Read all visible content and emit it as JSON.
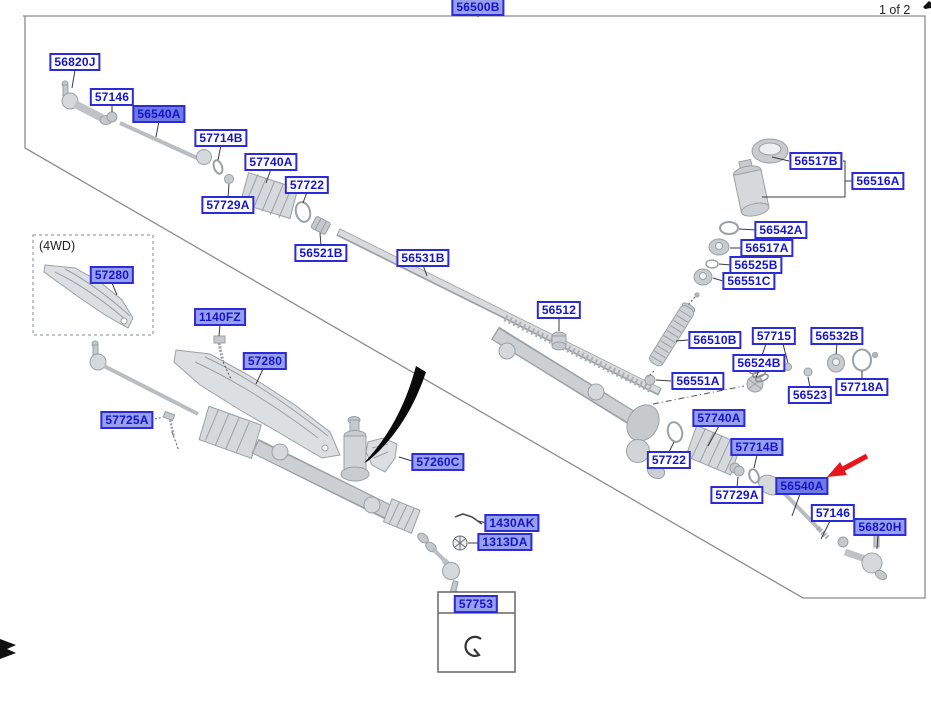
{
  "page": {
    "assembly_label": "56500B",
    "page_indicator": "1 of 2",
    "variant_note": "(4WD)",
    "inset_part_label": "57753"
  },
  "colors": {
    "label_text": "#1414cc",
    "label_border": "#2b2bd8",
    "label_highlight_fill": "#98a0ee",
    "label_selected_fill": "#6f7ae4",
    "arrow_red": "#e8151d",
    "artwork_stroke": "#9aa0a6",
    "artwork_fill": "#d6d9db",
    "border_gray": "#8c8c8c"
  },
  "icons": {
    "selection_arrow": "red-arrow-pointer",
    "bookmark_flag": "black-flag-marker",
    "corner_mark": "black-corner-mark",
    "inset_part_icon": "snap-ring"
  },
  "labels": [
    {
      "text": "56500B",
      "x": 478,
      "y": 7,
      "hl": 1
    },
    {
      "text": "56820J",
      "x": 75,
      "y": 62,
      "hl": 0
    },
    {
      "text": "57146",
      "x": 112,
      "y": 97,
      "hl": 0
    },
    {
      "text": "56540A",
      "x": 159,
      "y": 114,
      "hl": 2
    },
    {
      "text": "57714B",
      "x": 221,
      "y": 138,
      "hl": 0
    },
    {
      "text": "57740A",
      "x": 271,
      "y": 162,
      "hl": 0
    },
    {
      "text": "57722",
      "x": 307,
      "y": 185,
      "hl": 0
    },
    {
      "text": "57729A",
      "x": 228,
      "y": 205,
      "hl": 0
    },
    {
      "text": "56521B",
      "x": 321,
      "y": 253,
      "hl": 0
    },
    {
      "text": "56531B",
      "x": 423,
      "y": 258,
      "hl": 0
    },
    {
      "text": "56512",
      "x": 559,
      "y": 310,
      "hl": 0
    },
    {
      "text": "56517B",
      "x": 816,
      "y": 161,
      "hl": 0
    },
    {
      "text": "56516A",
      "x": 878,
      "y": 181,
      "hl": 0
    },
    {
      "text": "56542A",
      "x": 781,
      "y": 230,
      "hl": 0
    },
    {
      "text": "56517A",
      "x": 767,
      "y": 248,
      "hl": 0
    },
    {
      "text": "56525B",
      "x": 756,
      "y": 265,
      "hl": 0
    },
    {
      "text": "56551C",
      "x": 749,
      "y": 281,
      "hl": 0
    },
    {
      "text": "56510B",
      "x": 715,
      "y": 340,
      "hl": 0
    },
    {
      "text": "57715",
      "x": 774,
      "y": 336,
      "hl": 0
    },
    {
      "text": "56532B",
      "x": 837,
      "y": 336,
      "hl": 0
    },
    {
      "text": "56524B",
      "x": 759,
      "y": 363,
      "hl": 0
    },
    {
      "text": "56551A",
      "x": 698,
      "y": 381,
      "hl": 0
    },
    {
      "text": "56523",
      "x": 810,
      "y": 395,
      "hl": 0
    },
    {
      "text": "57718A",
      "x": 862,
      "y": 387,
      "hl": 0
    },
    {
      "text": "57740A",
      "x": 719,
      "y": 418,
      "hl": 1
    },
    {
      "text": "57722",
      "x": 669,
      "y": 460,
      "hl": 0
    },
    {
      "text": "57714B",
      "x": 757,
      "y": 447,
      "hl": 1
    },
    {
      "text": "57729A",
      "x": 737,
      "y": 495,
      "hl": 0
    },
    {
      "text": "56540A",
      "x": 802,
      "y": 486,
      "hl": 2
    },
    {
      "text": "57146",
      "x": 833,
      "y": 513,
      "hl": 0
    },
    {
      "text": "56820H",
      "x": 880,
      "y": 527,
      "hl": 1
    },
    {
      "text": "57280",
      "x": 112,
      "y": 275,
      "hl": 1
    },
    {
      "text": "1140FZ",
      "x": 220,
      "y": 317,
      "hl": 1
    },
    {
      "text": "57280",
      "x": 265,
      "y": 361,
      "hl": 1
    },
    {
      "text": "57725A",
      "x": 127,
      "y": 420,
      "hl": 1
    },
    {
      "text": "57260C",
      "x": 438,
      "y": 462,
      "hl": 1
    },
    {
      "text": "1430AK",
      "x": 512,
      "y": 523,
      "hl": 1
    },
    {
      "text": "1313DA",
      "x": 505,
      "y": 542,
      "hl": 1
    },
    {
      "text": "57753",
      "x": 476,
      "y": 604,
      "hl": 1
    }
  ]
}
